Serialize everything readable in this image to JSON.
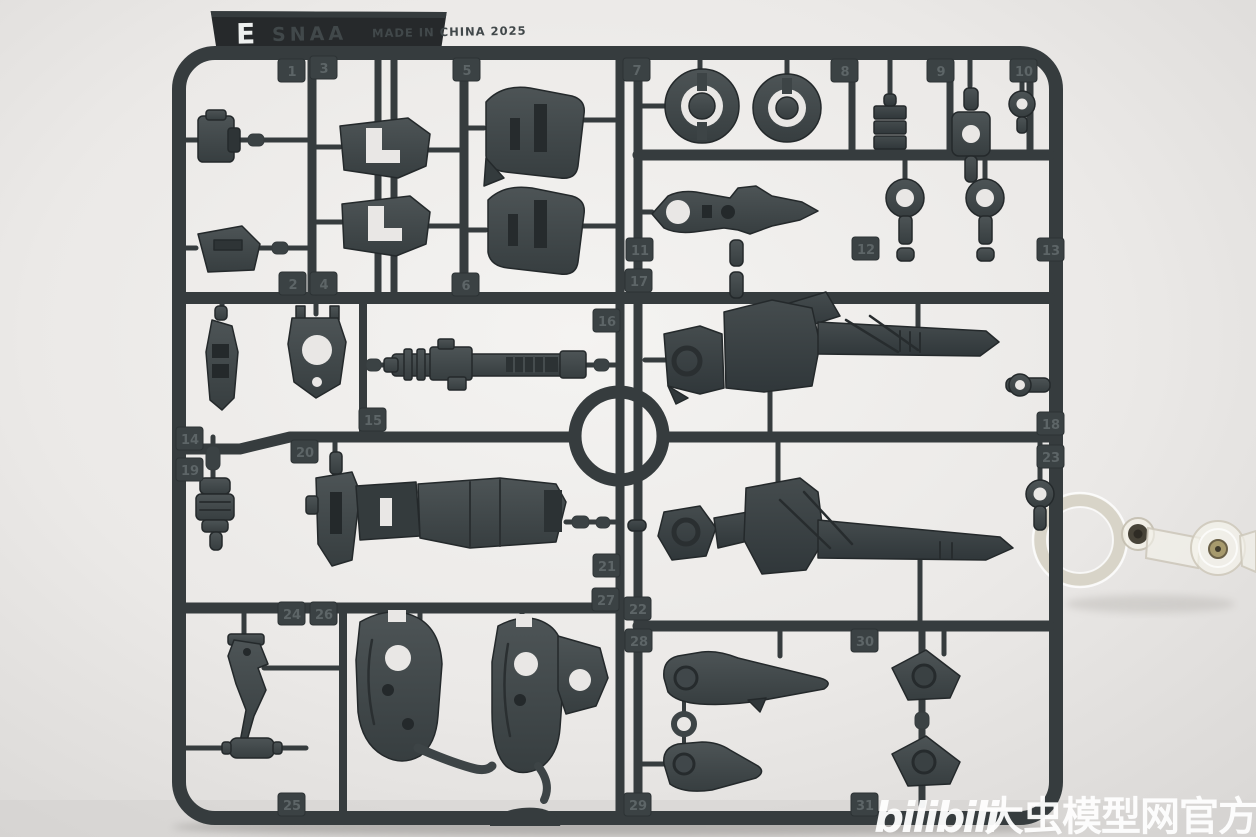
{
  "tag": {
    "letter": "E",
    "code": "SNAA",
    "made_in": "MADE IN CHINA 2025"
  },
  "runner": {
    "plastic_color": "#363c3e",
    "background_color": "#ebe9e7",
    "tabs": [
      {
        "n": "1",
        "x": 292,
        "y": 71
      },
      {
        "n": "3",
        "x": 324,
        "y": 68
      },
      {
        "n": "5",
        "x": 467,
        "y": 70
      },
      {
        "n": "7",
        "x": 637,
        "y": 70
      },
      {
        "n": "8",
        "x": 845,
        "y": 71
      },
      {
        "n": "9",
        "x": 941,
        "y": 71
      },
      {
        "n": "10",
        "x": 1024,
        "y": 71
      },
      {
        "n": "2",
        "x": 293,
        "y": 284
      },
      {
        "n": "4",
        "x": 324,
        "y": 284
      },
      {
        "n": "6",
        "x": 466,
        "y": 285
      },
      {
        "n": "11",
        "x": 640,
        "y": 250
      },
      {
        "n": "12",
        "x": 866,
        "y": 249
      },
      {
        "n": "13",
        "x": 1051,
        "y": 250
      },
      {
        "n": "17",
        "x": 639,
        "y": 281
      },
      {
        "n": "16",
        "x": 607,
        "y": 321
      },
      {
        "n": "15",
        "x": 373,
        "y": 420
      },
      {
        "n": "14",
        "x": 190,
        "y": 439
      },
      {
        "n": "19",
        "x": 190,
        "y": 470
      },
      {
        "n": "20",
        "x": 305,
        "y": 452
      },
      {
        "n": "18",
        "x": 1051,
        "y": 424
      },
      {
        "n": "23",
        "x": 1051,
        "y": 457
      },
      {
        "n": "21",
        "x": 607,
        "y": 566
      },
      {
        "n": "27",
        "x": 606,
        "y": 600
      },
      {
        "n": "22",
        "x": 638,
        "y": 609
      },
      {
        "n": "24",
        "x": 292,
        "y": 614
      },
      {
        "n": "26",
        "x": 324,
        "y": 614
      },
      {
        "n": "28",
        "x": 639,
        "y": 641
      },
      {
        "n": "30",
        "x": 865,
        "y": 641
      },
      {
        "n": "25",
        "x": 292,
        "y": 805
      },
      {
        "n": "29",
        "x": 638,
        "y": 805
      },
      {
        "n": "31",
        "x": 865,
        "y": 805
      }
    ]
  },
  "watermark": {
    "logo": "bilibili",
    "site": "大虫模型网官方",
    "color": "#ffffff"
  }
}
